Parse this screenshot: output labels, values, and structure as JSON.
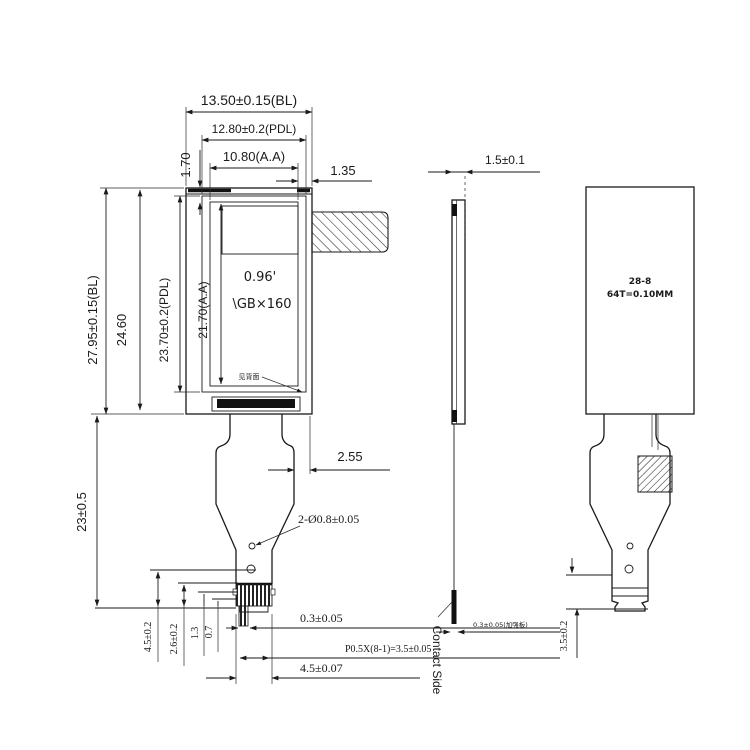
{
  "drawing": {
    "type": "mechanical-dimension-drawing",
    "subject": "0.96 inch LCD display module with FPC tail",
    "views": {
      "front": "front view",
      "side": "side profile view",
      "back": "back view"
    },
    "labels": {
      "top": {
        "bl_width": "13.50±0.15(BL)",
        "pdl_width": "12.80±0.2(PDL)",
        "aa_width": "10.80(A.A)",
        "edge_offset": "1.35",
        "top_margin": "1.70"
      },
      "left": {
        "bl_height": "27.95±0.15(BL)",
        "mid_height": "24.60",
        "pdl_height": "23.70±0.2(PDL)",
        "aa_height": "21.70(A.A)",
        "fpc_length": "23±0.5"
      },
      "screen": {
        "size": "0.96'",
        "resolution": "\\GB×160",
        "note": "见背面"
      },
      "fpc": {
        "offset": "2.55",
        "holes": "2-Ø0.8±0.05",
        "pin_width": "0.3±0.05",
        "pitch": "P0.5X(8-1)=3.5±0.05",
        "tail_width": "4.5±0.07",
        "h1": "4.5±0.2",
        "h2": "2.6±0.2",
        "h3": "1.3",
        "h4": "0.7"
      },
      "side": {
        "thickness": "1.5±0.1",
        "stiffener": "0.3±0.05(加强板)",
        "contact": "Contact Side"
      },
      "back": {
        "line1": "28-8",
        "line2": "64T=0.10MM",
        "tail_dim": "3.5±0.2"
      }
    },
    "colors": {
      "line": "#1a1a1a",
      "background": "#ffffff"
    }
  }
}
